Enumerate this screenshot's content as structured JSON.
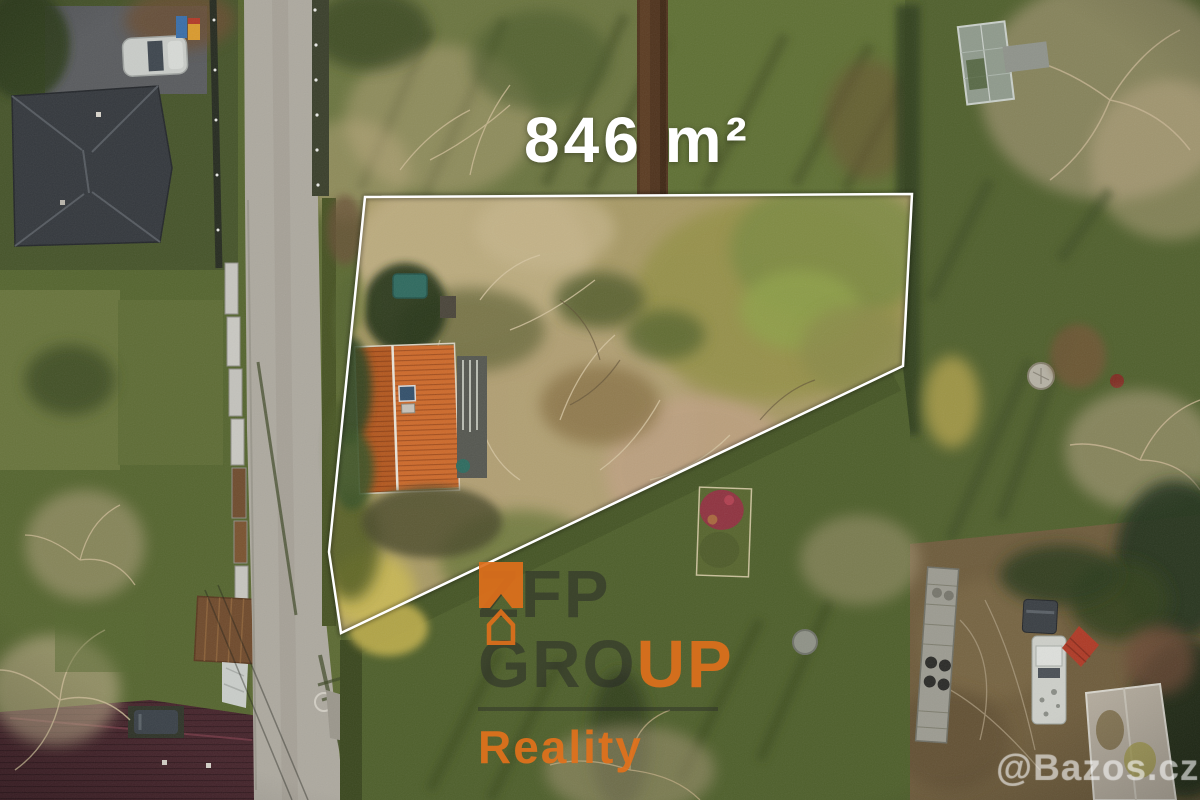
{
  "overlay": {
    "area_label": "846 m²",
    "zfp_watermark": {
      "brand_top": "ZFP",
      "brand_mid_dark": "GRO",
      "brand_mid_orange": "UP",
      "brand_bottom": "Reality"
    },
    "bazos_label": "@Bazos.cz"
  },
  "colors": {
    "watermark_orange": "#DE6F1B",
    "watermark_dark_text": "rgba(40,40,40,0.52)",
    "boundary_line": "#FFFFFF",
    "area_label_text": "#FFFFFF",
    "bazos_text": "rgba(242,242,242,0.34)",
    "roof_orange": "#CD6A2B",
    "roof_dark_slate": "#34383D",
    "roof_maroon": "#45242B",
    "road_gray": "#ADA99F",
    "meadow_tan": "#A89A66",
    "lawn_green": "#55652F"
  }
}
